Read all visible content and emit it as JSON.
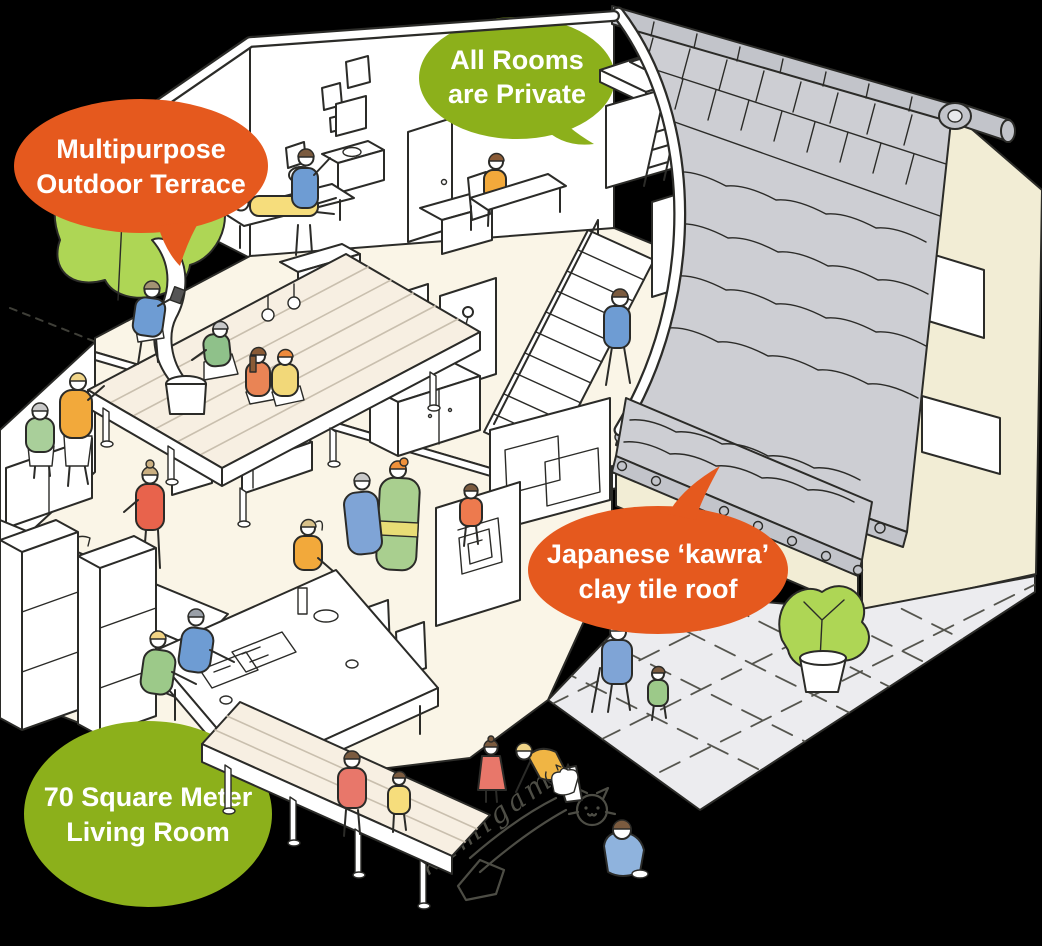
{
  "meta": {
    "type": "isometric cutaway illustration",
    "subject": "two-story share house with residents, terrace, courtyard and tiled roof",
    "background_color": "#000000",
    "outline_color": "#2B2B28"
  },
  "callouts": {
    "private_rooms": {
      "line1": "All Rooms",
      "line2": "are Private",
      "bubble_color": "#8CB01B",
      "text_color": "#FFFFFF",
      "shape": "speech-bubble"
    },
    "terrace": {
      "line1": "Multipurpose",
      "line2": "Outdoor Terrace",
      "bubble_color": "#E5591E",
      "text_color": "#FFFFFF",
      "shape": "speech-bubble"
    },
    "roof": {
      "line1": "Japanese ‘kawra’",
      "line2": "clay tile roof",
      "bubble_color": "#E5591E",
      "text_color": "#FFFFFF",
      "shape": "speech-bubble"
    },
    "living_room": {
      "line1": "70 Square Meter",
      "line2": "Living Room",
      "bubble_color": "#8CB01B",
      "text_color": "#FFFFFF",
      "shape": "speech-bubble"
    }
  },
  "chalk_writing": {
    "word": "kamigam",
    "color": "#4D4D45"
  },
  "palette": {
    "wall_cream": "#F2EDD5",
    "floor_cream": "#FAF5E7",
    "deck_wood": "#F7EFE2",
    "roof_gray": "#CDCED3",
    "ridge_gray": "#C2C4CA",
    "courtyard_gray": "#ECECEF",
    "tree_green": "#AED655",
    "white": "#FFFFFF"
  },
  "scene": {
    "figures": [
      "person-climbing-loft-ladder",
      "person-lying-on-bench",
      "person-waving-over-cabinet",
      "person-reading-at-desk",
      "person-studying-at-desk",
      "person-walking-upstairs-hall",
      "person-drilling-on-deck",
      "person-kneeling-at-bucket",
      "person-sitting-on-deck-1",
      "person-sitting-on-deck-2",
      "neighbor-walking-1",
      "neighbor-walking-2",
      "person-cooking-at-kitchen-counter",
      "person-reading-at-dining-table-1",
      "person-reading-at-dining-table-2",
      "person-at-far-side-of-table",
      "person-dressing-kimono",
      "person-being-dressed-in-kimono",
      "child-standing",
      "elderly-man-with-cane",
      "child-in-courtyard",
      "girl-in-red-dress",
      "adult-drawing-with-chalk",
      "white-cat",
      "child-drawing-on-ground",
      "person-sitting-on-porch",
      "child-sitting-on-porch"
    ],
    "elements": [
      "kawara-tiled-roof",
      "ridge-finial",
      "gable-wall-with-windows",
      "second-floor-private-rooms",
      "loft-bed-with-ladder",
      "staircase",
      "shower-stalls",
      "toilet",
      "washbasin",
      "bed",
      "study-desks",
      "kitchen-counter-with-sink",
      "tall-cupboards",
      "dining-table",
      "tv-on-cabinet",
      "sofa",
      "shoji-partition",
      "wooden-deck-terrace",
      "steam-from-bucket",
      "tree",
      "entrance-roof",
      "entrance-sliding-door",
      "tiled-courtyard",
      "potted-shrub",
      "engawa-porch",
      "chalk-cat-doodle",
      "chalk-arrow",
      "property-boundary-dashes"
    ]
  }
}
